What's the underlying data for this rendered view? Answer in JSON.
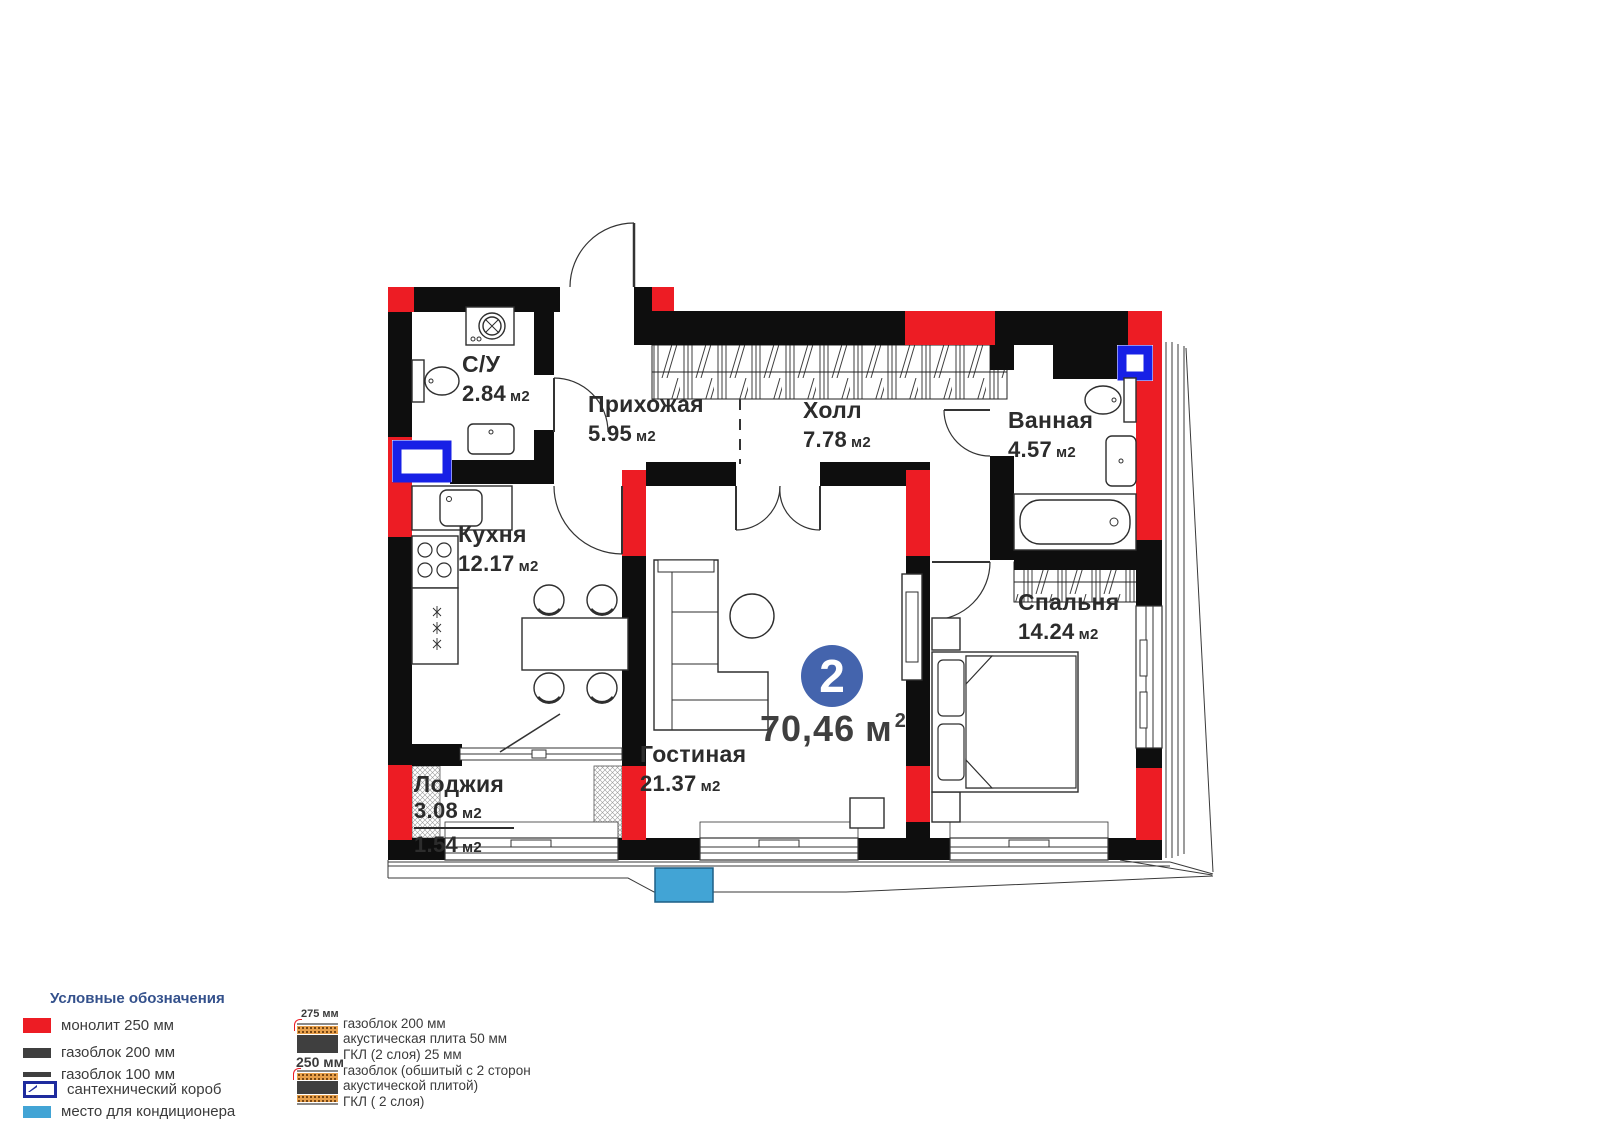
{
  "plan": {
    "unit": {
      "rooms": "2",
      "area_value": "70,46",
      "area_unit": "м",
      "area_sup": "2"
    },
    "rooms": [
      {
        "name": "С/У",
        "value": "2.84",
        "unit": "м2"
      },
      {
        "name": "Прихожая",
        "value": "5.95",
        "unit": "м2"
      },
      {
        "name": "Холл",
        "value": "7.78",
        "unit": "м2"
      },
      {
        "name": "Ванная",
        "value": "4.57",
        "unit": "м2"
      },
      {
        "name": "Кухня",
        "value": "12.17",
        "unit": "м2"
      },
      {
        "name": "Спальня",
        "value": "14.24",
        "unit": "м2"
      },
      {
        "name": "Гостиная",
        "value": "21.37",
        "unit": "м2"
      },
      {
        "name": "Лоджия",
        "value": "3.08",
        "unit": "м2",
        "value2": "1.54",
        "unit2": "м2"
      }
    ]
  },
  "legend": {
    "title": "Условные обозначения",
    "items": [
      {
        "label": "монолит 250 мм",
        "color": "#ed1c24"
      },
      {
        "label": "газоблок 200 мм",
        "color": "#3f3f3f"
      },
      {
        "label": "газоблок 100 мм",
        "color": "#3f3f3f"
      },
      {
        "label": "сантехнический короб",
        "color": "#1e2b9e"
      },
      {
        "label": "место для кондиционера",
        "color": "#42a4d5"
      }
    ],
    "wall_types": [
      {
        "size": "275 мм",
        "lines": [
          "газоблок 200 мм",
          "акустическая плита 50 мм",
          "ГКЛ (2 слоя) 25 мм"
        ]
      },
      {
        "size": "250 мм",
        "lines": [
          "газоблок (обшитый с 2 сторон",
          "акустической плитой)",
          "ГКЛ ( 2 слоя)"
        ]
      }
    ]
  },
  "colors": {
    "wall_monolith_red": "#ed1c24",
    "wall_black": "#0e0e0e",
    "sanitary_blue": "#1720e6",
    "ac_blue": "#42a4d5",
    "badge_blue": "#4464ad"
  }
}
